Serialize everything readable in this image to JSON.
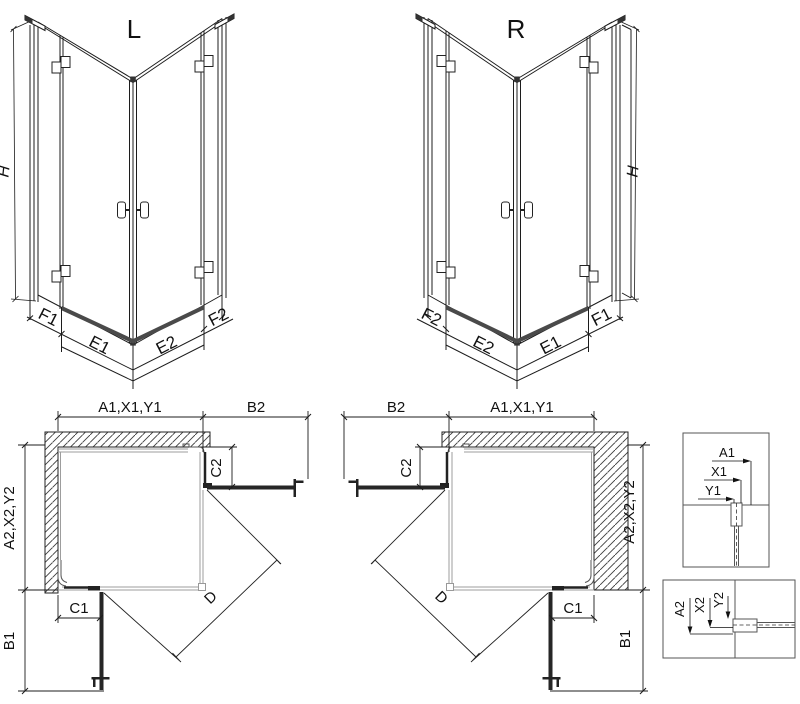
{
  "figure": {
    "left_3d": {
      "title": "L",
      "height_dim": "H",
      "base_dims": [
        "F1",
        "E1",
        "E2",
        "F2"
      ]
    },
    "right_3d": {
      "title": "R",
      "height_dim": "H",
      "base_dims": [
        "F2",
        "E2",
        "E1",
        "F1"
      ]
    },
    "left_plan": {
      "width_dim": "A1,X1,Y1",
      "door_width_dim": "B2",
      "fixed_side_dim": "C2",
      "depth_dim": "A2,X2,Y2",
      "fixed_front_dim": "C1",
      "door_depth_dim": "B1",
      "diagonal_dim": "D"
    },
    "right_plan": {
      "width_dim": "A1,X1,Y1",
      "door_width_dim": "B2",
      "fixed_side_dim": "C2",
      "depth_dim": "A2,X2,Y2",
      "fixed_front_dim": "C1",
      "door_depth_dim": "B1",
      "diagonal_dim": "D"
    },
    "detail_top": {
      "dims": [
        "A1",
        "X1",
        "Y1"
      ]
    },
    "detail_bottom": {
      "dims": [
        "A2",
        "X2",
        "Y2"
      ]
    }
  },
  "colors": {
    "ink": "#1c1c1c",
    "gray_edge": "#9d9d9d",
    "dark_fill": "#4a4a4a",
    "door_fill": "#262626",
    "background": "#ffffff"
  }
}
